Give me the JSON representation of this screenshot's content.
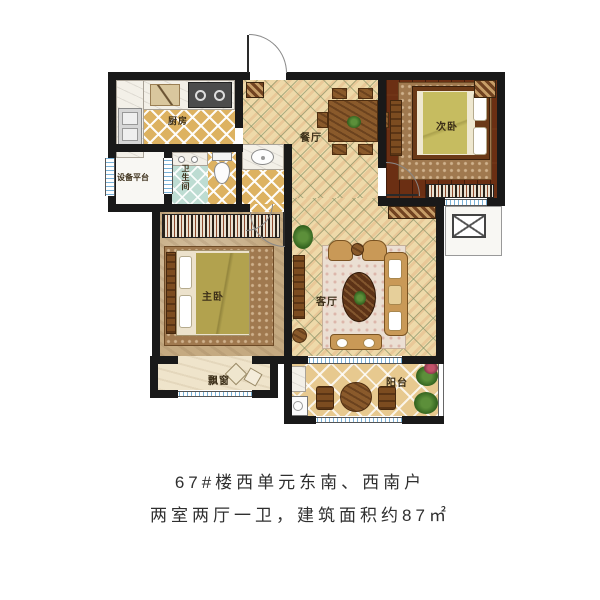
{
  "plan": {
    "rooms": [
      {
        "id": "kitchen",
        "label": "厨房"
      },
      {
        "id": "dining",
        "label": "餐厅"
      },
      {
        "id": "bedroom2",
        "label": "次卧"
      },
      {
        "id": "equipment",
        "label": "设备平台"
      },
      {
        "id": "bathroom",
        "label": "卫生间"
      },
      {
        "id": "master",
        "label": "主卧"
      },
      {
        "id": "living",
        "label": "客厅"
      },
      {
        "id": "bay",
        "label": "飘窗"
      },
      {
        "id": "balcony",
        "label": "阳台"
      }
    ],
    "caption": {
      "line1": "67#楼西单元东南、西南户",
      "line2": "两室两厅一卫，建筑面积约87㎡"
    },
    "colors": {
      "wall": "#191919",
      "tile_tan": "#eed9a9",
      "tile_gold": "#ddb261",
      "tile_teal": "#bddcd2",
      "wood_dark": "#6b2f13",
      "floor_beige": "#c5aa81",
      "window_blue": "#79b2d8",
      "caption_text": "#2f2f2f"
    }
  }
}
